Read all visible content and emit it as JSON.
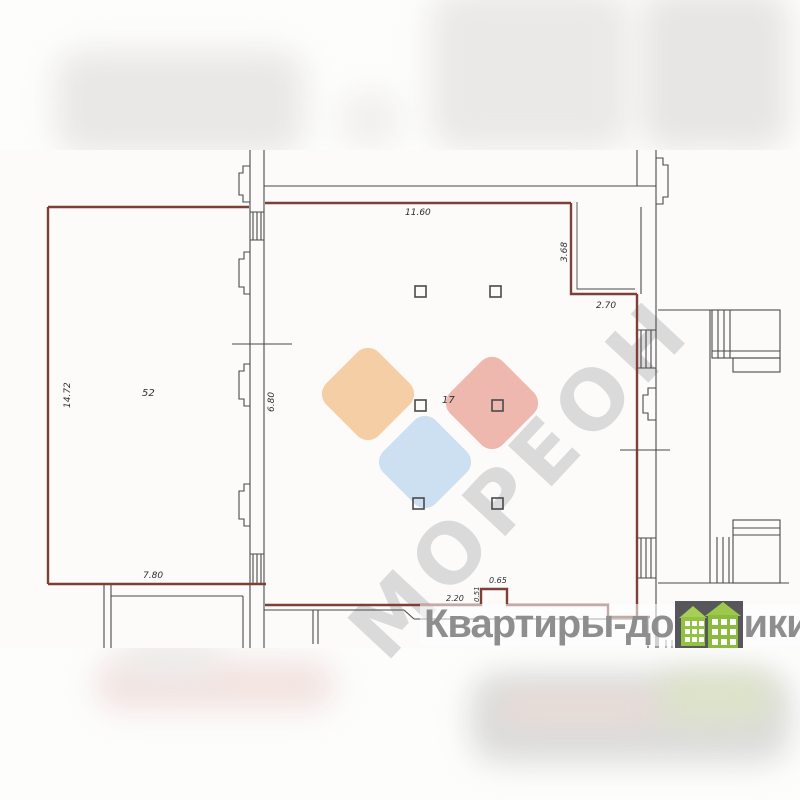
{
  "watermark": {
    "brand_diagonal": "МОРЕОН",
    "site_left": "Квартиры-до",
    "site_right": "ики.рф"
  },
  "plan": {
    "rooms": {
      "left_room_label": "52",
      "main_room_label": "17"
    },
    "dimensions": {
      "top_width": "11.60",
      "notch_height": "3.68",
      "notch_width": "2.70",
      "left_height": "14.72",
      "inner_wall_height": "6.80",
      "left_room_bottom_width": "7.80",
      "bottom_step_a": "2.20",
      "bottom_step_b": "0.51",
      "bottom_step_c": "0.65"
    },
    "colors": {
      "boundary_red": "#7d4036",
      "line_dark": "#4a4a4c",
      "logo_orange": "#f6cb9e",
      "logo_pink": "#eeb3a8",
      "logo_blue": "#cadef2",
      "diagonal_watermark_gray": "#d6d5d5",
      "site_text_gray": "#8e8e8e",
      "house_green": "#8abb3e",
      "house_badge_dark": "#57565b"
    }
  }
}
